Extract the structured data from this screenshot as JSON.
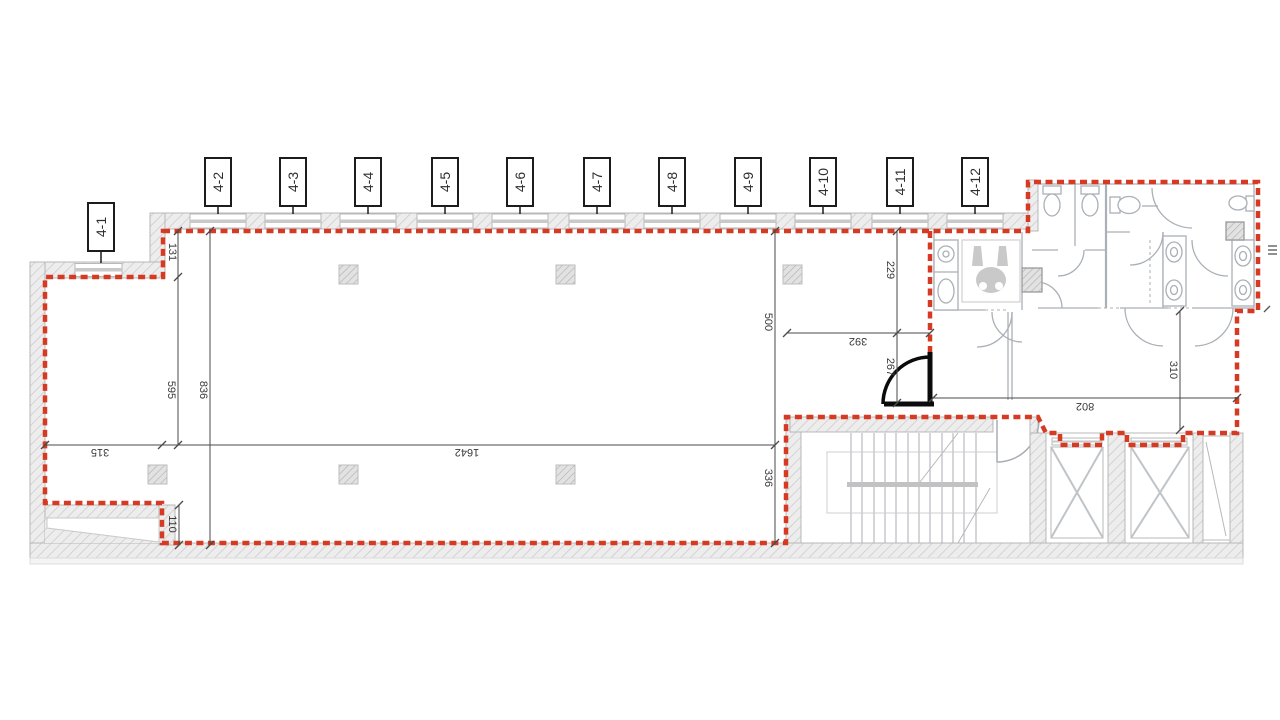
{
  "plan": {
    "axis_labels": [
      "4-1",
      "4-2",
      "4-3",
      "4-4",
      "4-5",
      "4-6",
      "4-7",
      "4-8",
      "4-9",
      "4-10",
      "4-11",
      "4-12"
    ],
    "dimensions": {
      "d131": "131",
      "d595": "595",
      "d836": "836",
      "d315": "315",
      "d110": "110",
      "d1642": "1642",
      "d500": "500",
      "d336": "336",
      "d229": "229",
      "d392": "392",
      "d267": "267",
      "d802": "802",
      "d310": "310"
    },
    "colors": {
      "boundary_red": "#d63a22",
      "wall_fill": "#ededed",
      "wall_hatch_line": "#c9c9c9",
      "partition_gray": "#aab0b6",
      "dimension_gray": "#4a4a4a",
      "door_black": "#0b0b0b",
      "background": "#ffffff"
    }
  }
}
